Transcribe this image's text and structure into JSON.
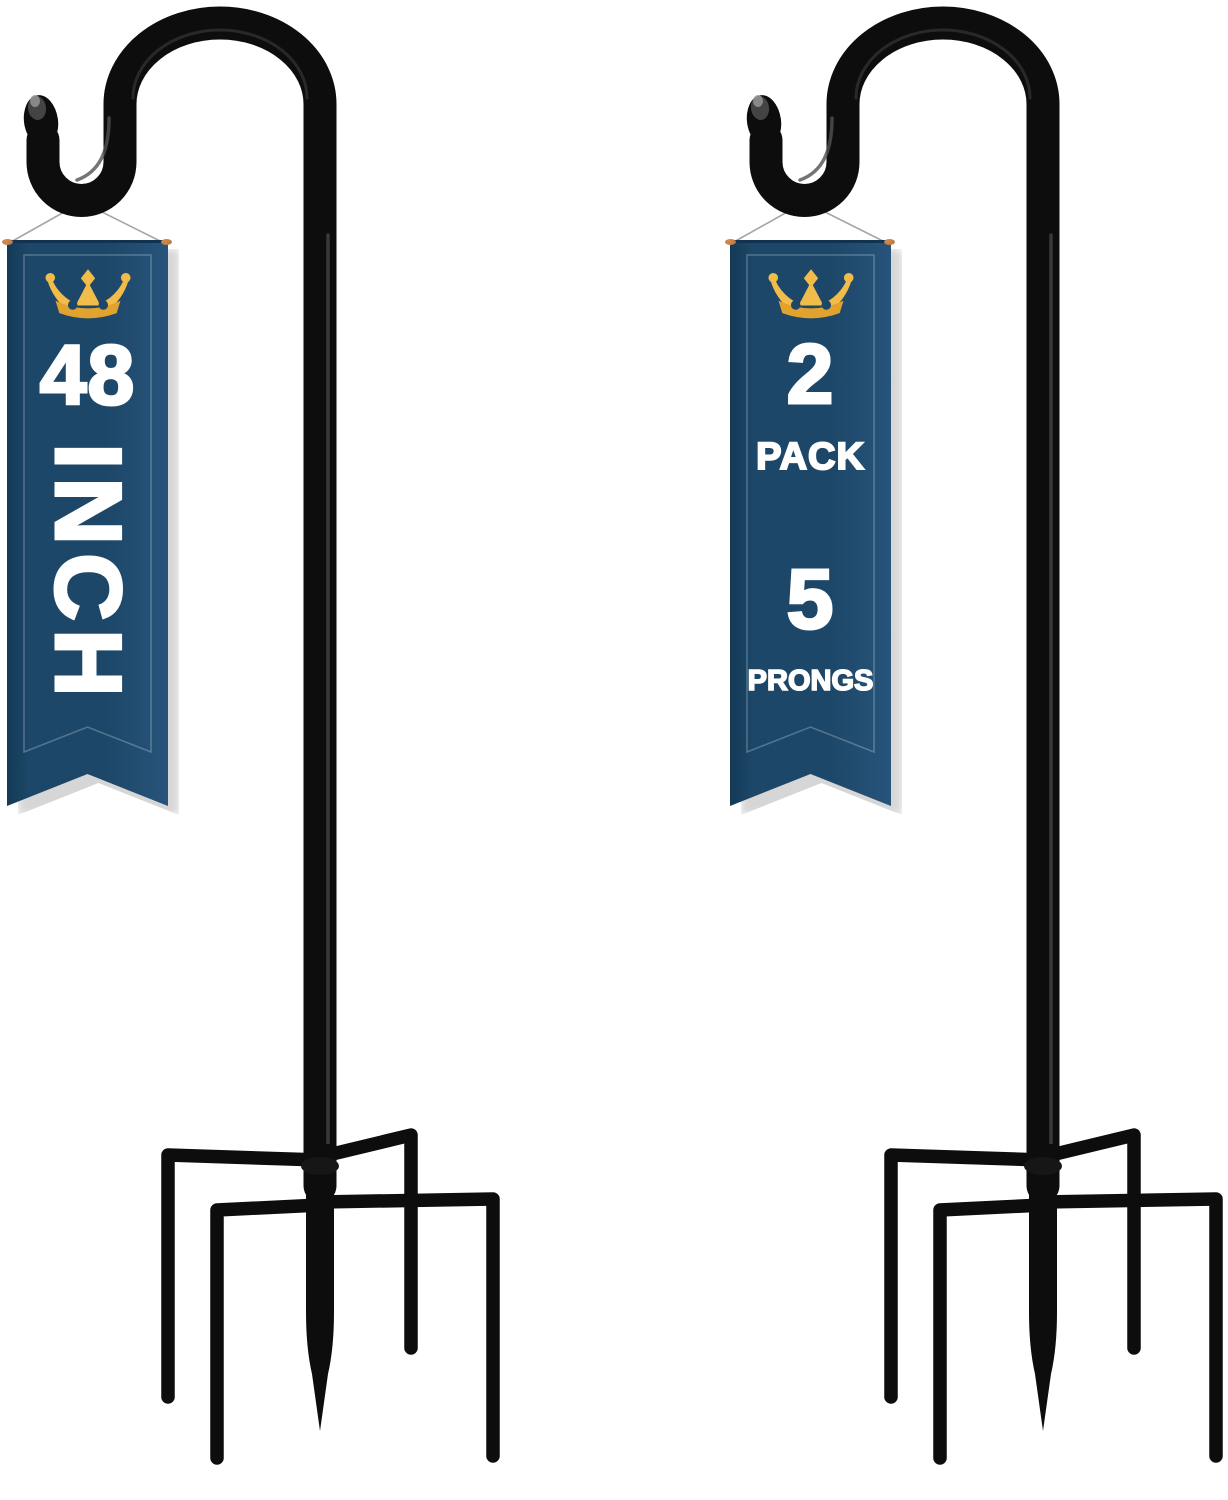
{
  "colors": {
    "background": "#ffffff",
    "navy": "#1d4768",
    "navy_edge": "#133a57",
    "navy_light": "#27547b",
    "rod_dark": "#123350",
    "gold": "#f2bc4a",
    "gold_deep": "#e2a22e",
    "copper": "#b8733c",
    "string": "#a6a6a6",
    "pole": "#0d0d0d",
    "shadow": "#cfcfcf",
    "text": "#ffffff",
    "inner_border": "rgba(255,255,255,0.25)"
  },
  "left_banner": {
    "icon": "crown-icon",
    "size_value": "48",
    "size_unit": "INCH"
  },
  "right_banner": {
    "icon": "crown-icon",
    "pack_value": "2",
    "pack_label": "PACK",
    "prongs_value": "5",
    "prongs_label": "PRONGS"
  }
}
